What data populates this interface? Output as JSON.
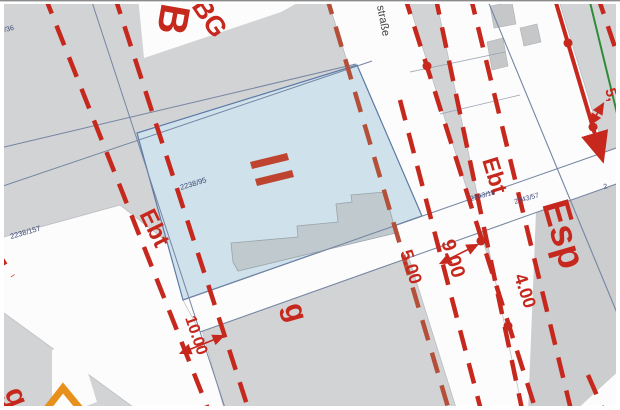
{
  "map_type": "cadastral-site-plan",
  "colors": {
    "background": "#d2d3d4",
    "street": "#fcfcfc",
    "red": "#c6281e",
    "dash_brown": "#b4503a",
    "parcel_blue": "#cfe1ea",
    "parcel_border": "#5d7aa6",
    "building_gray": "#c6c7c9",
    "building_in_parcel": "#bfc9ce",
    "boundary_thin": "#7585a3",
    "boundary_faint": "#98a0b0",
    "green_line": "#2f8b35",
    "orange": "#e8901c",
    "parcel_number": "#3c4878",
    "esp_gray": "#cccdcf",
    "street_name_color": "#3f3f3f"
  },
  "polygons": [
    {
      "name": "street-left",
      "points": [
        [
          0,
          238
        ],
        [
          120,
          205
        ],
        [
          180,
          252
        ],
        [
          225,
          412
        ],
        [
          140,
          412
        ],
        [
          0,
          310
        ]
      ],
      "fill": "street",
      "stroke": "#b6b9bf",
      "sw": 0.7
    },
    {
      "name": "street-center",
      "points": [
        [
          326,
          -6
        ],
        [
          406,
          -6
        ],
        [
          537,
          414
        ],
        [
          458,
          414
        ]
      ],
      "fill": "street",
      "stroke": "#b6b9bf",
      "sw": 0.7
    },
    {
      "name": "street-right",
      "points": [
        [
          435,
          -6
        ],
        [
          557,
          -6
        ],
        [
          622,
          208
        ],
        [
          622,
          412
        ],
        [
          523,
          412
        ]
      ],
      "fill": "street",
      "stroke": "#b6b9bf",
      "sw": 0.7
    },
    {
      "name": "street-diagonal-band",
      "points": [
        [
          183,
          300
        ],
        [
          622,
          146
        ],
        [
          622,
          182
        ],
        [
          200,
          332
        ]
      ],
      "fill": "street",
      "stroke": "#b6b9bf",
      "sw": 0.7
    },
    {
      "name": "block-top-left-white",
      "points": [
        [
          138,
          -4
        ],
        [
          310,
          -4
        ],
        [
          281,
          12
        ],
        [
          144,
          58
        ]
      ],
      "fill": "street"
    },
    {
      "name": "block-bottom-left-white",
      "points": [
        [
          52,
          350
        ],
        [
          78,
          341
        ],
        [
          97,
          402
        ],
        [
          70,
          412
        ],
        [
          52,
          412
        ]
      ],
      "fill": "street"
    },
    {
      "name": "area-esp-gray",
      "points": [
        [
          536,
          212
        ],
        [
          622,
          182
        ],
        [
          622,
          368
        ],
        [
          572,
          414
        ],
        [
          528,
          414
        ]
      ],
      "fill": "esp_gray"
    },
    {
      "name": "corner-bottom-right-white",
      "points": [
        [
          622,
          368
        ],
        [
          622,
          414
        ],
        [
          572,
          414
        ]
      ],
      "fill": "street"
    },
    {
      "name": "block-top-right-white",
      "points": [
        [
          530,
          50
        ],
        [
          551,
          43
        ],
        [
          575,
          120
        ],
        [
          553,
          128
        ]
      ],
      "fill": "street"
    },
    {
      "name": "block-top-right-white-2",
      "points": [
        [
          456,
          4
        ],
        [
          477,
          0
        ],
        [
          480,
          28
        ],
        [
          462,
          32
        ]
      ],
      "fill": "street"
    },
    {
      "name": "building-gray-1",
      "points": [
        [
          487,
          42
        ],
        [
          503,
          38
        ],
        [
          508,
          66
        ],
        [
          492,
          70
        ]
      ],
      "fill": "building_gray",
      "stroke": "#aeb0b3",
      "sw": 0.6
    },
    {
      "name": "building-gray-2",
      "points": [
        [
          520,
          28
        ],
        [
          537,
          24
        ],
        [
          541,
          42
        ],
        [
          524,
          46
        ]
      ],
      "fill": "building_gray",
      "stroke": "#aeb0b3",
      "sw": 0.6
    },
    {
      "name": "building-gray-3",
      "points": [
        [
          490,
          6
        ],
        [
          512,
          2
        ],
        [
          516,
          24
        ],
        [
          494,
          28
        ]
      ],
      "fill": "building_gray",
      "stroke": "#aeb0b3",
      "sw": 0.6
    },
    {
      "name": "highlight-parcel",
      "points": [
        [
          137,
          133
        ],
        [
          357,
          65
        ],
        [
          422,
          216
        ],
        [
          183,
          300
        ]
      ],
      "fill": "parcel_blue",
      "stroke": "#5d7aa6",
      "sw": 1.2
    },
    {
      "name": "building-in-parcel",
      "points": [
        [
          233,
          262
        ],
        [
          231,
          243
        ],
        [
          298,
          237
        ],
        [
          297,
          226
        ],
        [
          338,
          222
        ],
        [
          336,
          204
        ],
        [
          352,
          202
        ],
        [
          351,
          195
        ],
        [
          385,
          192
        ],
        [
          396,
          233
        ],
        [
          238,
          271
        ]
      ],
      "fill": "building_in_parcel",
      "stroke": "#9aa4ab",
      "sw": 0.8
    },
    {
      "name": "storey-marker-bar-1",
      "points": [
        [
          250,
          162
        ],
        [
          287,
          153
        ],
        [
          289,
          160
        ],
        [
          252,
          169
        ]
      ],
      "fill": "#bf4430"
    },
    {
      "name": "storey-marker-bar-2",
      "points": [
        [
          255,
          179
        ],
        [
          292,
          170
        ],
        [
          294,
          177
        ],
        [
          257,
          186
        ]
      ],
      "fill": "#bf4430"
    }
  ],
  "thin_lines": [
    {
      "name": "boundary-1",
      "x1": 90,
      "y1": -4,
      "x2": 227,
      "y2": 414,
      "color": "boundary_thin",
      "w": 1
    },
    {
      "name": "boundary-2",
      "x1": 0,
      "y1": 187,
      "x2": 372,
      "y2": 61,
      "color": "boundary_thin",
      "w": 1
    },
    {
      "name": "boundary-3",
      "x1": 0,
      "y1": 148,
      "x2": 356,
      "y2": 64,
      "color": "boundary_thin",
      "w": 1
    },
    {
      "name": "boundary-4",
      "x1": 183,
      "y1": 300,
      "x2": 622,
      "y2": 146,
      "color": "boundary_thin",
      "w": 1
    },
    {
      "name": "boundary-5",
      "x1": 200,
      "y1": 332,
      "x2": 622,
      "y2": 182,
      "color": "boundary_thin",
      "w": 1
    },
    {
      "name": "boundary-6",
      "x1": 485,
      "y1": -6,
      "x2": 622,
      "y2": 325,
      "color": "boundary_thin",
      "w": 1.1
    },
    {
      "name": "boundary-7",
      "x1": 410,
      "y1": 72,
      "x2": 505,
      "y2": 52,
      "color": "boundary_faint",
      "w": 0.8
    },
    {
      "name": "boundary-8",
      "x1": 440,
      "y1": 114,
      "x2": 520,
      "y2": 95,
      "color": "boundary_faint",
      "w": 0.8
    }
  ],
  "red_lines": [
    {
      "name": "zoning-dash-a",
      "x1": 44,
      "y1": -6,
      "x2": 210,
      "y2": 414,
      "dash": true
    },
    {
      "name": "zoning-dash-b",
      "x1": 114,
      "y1": -6,
      "x2": 250,
      "y2": 414,
      "dash": true
    },
    {
      "name": "zoning-dash-c",
      "x1": 326,
      "y1": -6,
      "x2": 450,
      "y2": 414,
      "dash": true,
      "color": "dash_brown"
    },
    {
      "name": "zoning-dash-k",
      "x1": 400,
      "y1": 100,
      "x2": 482,
      "y2": 414,
      "dash": true
    },
    {
      "name": "zoning-dash-d",
      "x1": 404,
      "y1": -6,
      "x2": 537,
      "y2": 414,
      "dash": true
    },
    {
      "name": "zoning-dash-e",
      "x1": 435,
      "y1": -6,
      "x2": 523,
      "y2": 414,
      "dash": true
    },
    {
      "name": "zoning-dash-f",
      "x1": 470,
      "y1": -6,
      "x2": 572,
      "y2": 414,
      "dash": true
    },
    {
      "name": "zoning-dash-top-right",
      "x1": 597,
      "y1": -6,
      "x2": 626,
      "y2": 80,
      "dash": true
    },
    {
      "name": "zoning-dash-bottom-right",
      "x1": 588,
      "y1": 375,
      "x2": 605,
      "y2": 414,
      "dash": true
    },
    {
      "name": "zoning-dash-left-stub",
      "x1": -6,
      "y1": 247,
      "x2": 13,
      "y2": 276,
      "dash": true
    },
    {
      "name": "boundary-solid-arrow",
      "x1": 554,
      "y1": -4,
      "x2": 602,
      "y2": 158,
      "dash": false,
      "w": 4,
      "arrowEnd": true
    },
    {
      "name": "dim-arrow-10",
      "x1": 181,
      "y1": 353,
      "x2": 223,
      "y2": 336,
      "dash": false,
      "w": 1.6,
      "arrowBoth": true
    },
    {
      "name": "dim-arrow-9",
      "x1": 441,
      "y1": 263,
      "x2": 477,
      "y2": 245,
      "dash": false,
      "w": 1.6,
      "arrowBoth": true
    },
    {
      "name": "dim-arrow-edge",
      "x1": 591,
      "y1": 124,
      "x2": 603,
      "y2": 104,
      "dash": false,
      "w": 1.6,
      "arrowBoth": true
    }
  ],
  "green_lines": [
    {
      "name": "green-boundary",
      "x1": 588,
      "y1": -6,
      "x2": 624,
      "y2": 142,
      "w": 2
    }
  ],
  "dots": [
    {
      "name": "boundary-point-1",
      "cx": 427,
      "cy": 66,
      "r": 4.5
    },
    {
      "name": "boundary-point-2",
      "cx": 568,
      "cy": 43,
      "r": 4.5
    },
    {
      "name": "boundary-point-3",
      "cx": 593,
      "cy": 127,
      "r": 4.5
    },
    {
      "name": "boundary-point-4",
      "cx": 481,
      "cy": 241,
      "r": 4.5
    },
    {
      "name": "boundary-point-5",
      "cx": 508,
      "cy": 326,
      "r": 4.5
    }
  ],
  "polylines": [
    {
      "name": "orange-chevron",
      "points": [
        [
          45,
          411
        ],
        [
          63,
          388
        ],
        [
          82,
          411
        ]
      ],
      "stroke": "orange",
      "w": 7
    }
  ],
  "labels": [
    {
      "name": "zone-b-partial",
      "text": "B",
      "x": 162,
      "y": 2,
      "rot": 100,
      "size": 42,
      "color": "red",
      "bold": true
    },
    {
      "name": "zone-bg",
      "text": "BG",
      "x": 191,
      "y": 6,
      "rot": 56,
      "size": 27,
      "color": "red",
      "bold": true
    },
    {
      "name": "street-name",
      "text": "straße",
      "x": 377,
      "y": 6,
      "rot": 79,
      "size": 11,
      "color": "street_name_color",
      "bold": false
    },
    {
      "name": "zone-ebt-left",
      "text": "Ebt",
      "x": 139,
      "y": 214,
      "rot": 64,
      "size": 24,
      "color": "red",
      "bold": true
    },
    {
      "name": "zone-ebt-right",
      "text": "Ebt",
      "x": 482,
      "y": 160,
      "rot": 73,
      "size": 23,
      "color": "red",
      "bold": true
    },
    {
      "name": "zone-esp",
      "text": "Esp",
      "x": 542,
      "y": 204,
      "rot": 74,
      "size": 38,
      "color": "red",
      "bold": true
    },
    {
      "name": "zone-g-center",
      "text": "g",
      "x": 284,
      "y": 306,
      "rot": 74,
      "size": 30,
      "color": "red",
      "bold": true
    },
    {
      "name": "zone-g-bottom-left",
      "text": "g",
      "x": 4,
      "y": 392,
      "rot": 68,
      "size": 30,
      "color": "red",
      "bold": true
    },
    {
      "name": "dim-10-00",
      "text": "10.00",
      "x": 185,
      "y": 318,
      "rot": 71,
      "size": 16,
      "color": "red",
      "bold": true
    },
    {
      "name": "dim-5-00",
      "text": "5.00",
      "x": 400,
      "y": 252,
      "rot": 72,
      "size": 18,
      "color": "red",
      "bold": true
    },
    {
      "name": "dim-9-00",
      "text": "9.00",
      "x": 441,
      "y": 242,
      "rot": 72,
      "size": 20,
      "color": "red",
      "bold": true
    },
    {
      "name": "dim-4-00",
      "text": "4.00",
      "x": 514,
      "y": 276,
      "rot": 72,
      "size": 18,
      "color": "red",
      "bold": true
    },
    {
      "name": "dim-partial-edge",
      "text": "5,",
      "x": 605,
      "y": 90,
      "rot": 72,
      "size": 15,
      "color": "red",
      "bold": true
    },
    {
      "name": "parcel-2238-95",
      "text": "2238/95",
      "x": 181,
      "y": 190,
      "rot": -17,
      "size": 7.5,
      "color": "parcel_number",
      "bold": false
    },
    {
      "name": "parcel-2238-157",
      "text": "2238/157",
      "x": 11,
      "y": 239,
      "rot": -16,
      "size": 7.5,
      "color": "parcel_number",
      "bold": false
    },
    {
      "name": "parcel-2243-18",
      "text": "2243/18",
      "x": 471,
      "y": 201,
      "rot": -16,
      "size": 7,
      "color": "parcel_number",
      "bold": false
    },
    {
      "name": "parcel-2243-57",
      "text": "2243/57",
      "x": 515,
      "y": 204,
      "rot": -16,
      "size": 7,
      "color": "parcel_number",
      "bold": false
    },
    {
      "name": "parcel-9-36",
      "text": "9/36",
      "x": 1,
      "y": 33,
      "rot": -14,
      "size": 7,
      "color": "parcel_number",
      "bold": false
    },
    {
      "name": "parcel-partial-2",
      "text": "2",
      "x": 604,
      "y": 189,
      "rot": -14,
      "size": 7,
      "color": "parcel_number",
      "bold": false
    }
  ]
}
